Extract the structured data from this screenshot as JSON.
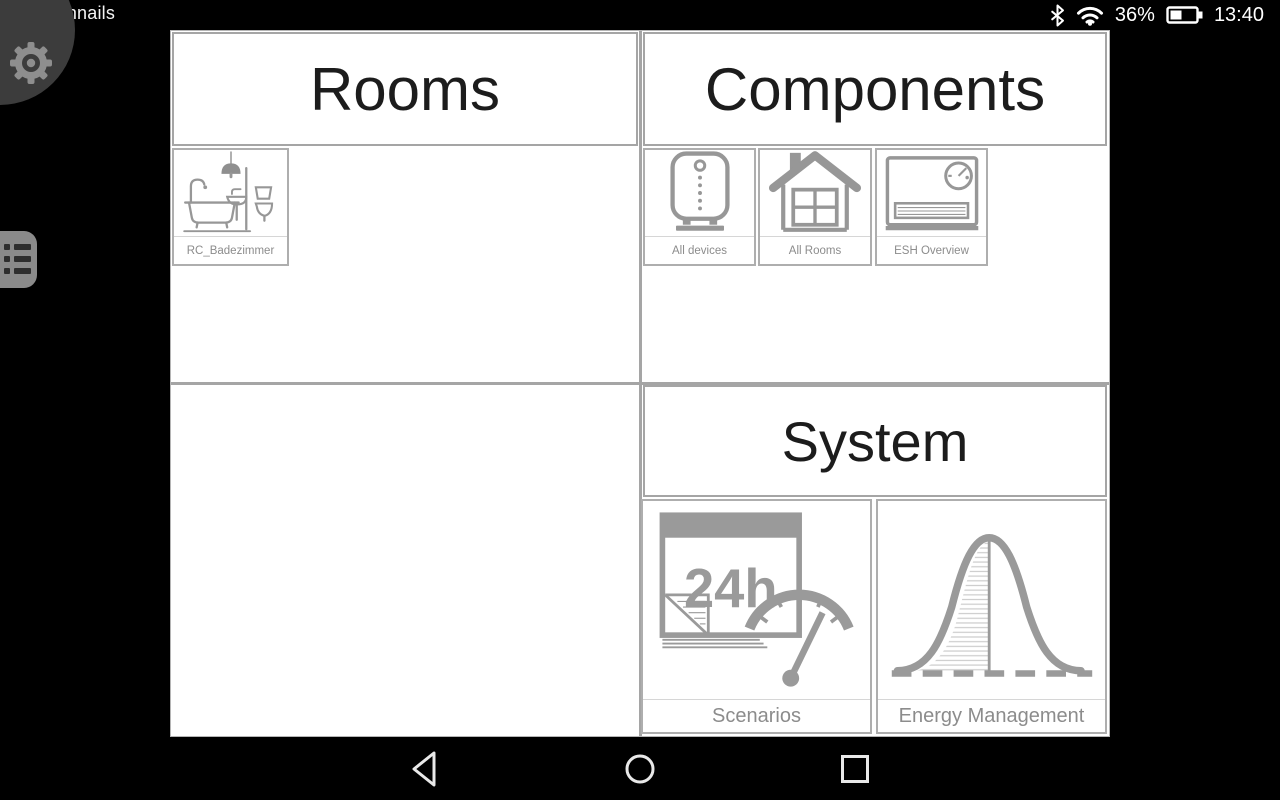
{
  "status_bar": {
    "device_name": "8inchnails",
    "battery_percent": "36%",
    "time": "13:40",
    "icons": [
      "bluetooth-icon",
      "wifi-icon",
      "battery-icon"
    ]
  },
  "sections": {
    "rooms": {
      "title": "Rooms",
      "tiles": [
        {
          "label": "RC_Badezimmer",
          "icon": "bathroom-icon"
        }
      ]
    },
    "components": {
      "title": "Components",
      "tiles": [
        {
          "label": "All devices",
          "icon": "smart-device-icon"
        },
        {
          "label": "All Rooms",
          "icon": "house-icon"
        },
        {
          "label": "ESH Overview",
          "icon": "heater-icon"
        }
      ]
    },
    "system": {
      "title": "System",
      "tiles": [
        {
          "label": "Scenarios",
          "icon": "calendar-gauge-icon",
          "icon_text": "24h"
        },
        {
          "label": "Energy Management",
          "icon": "bell-curve-icon"
        }
      ]
    }
  },
  "side_controls": {
    "settings": "gear-icon",
    "menu": "list-menu-icon"
  },
  "nav_bar": {
    "back": "back-icon",
    "home": "home-icon",
    "recents": "recents-icon"
  },
  "colors": {
    "grid_border": "#a5a5a5",
    "tile_border": "#aeaeae",
    "icon_stroke": "#979797",
    "label_text": "#8c8c8c",
    "header_text": "#1c1c1c",
    "status_text": "#ffffff",
    "blob_bg": "#3c3c3c",
    "menu_bg": "#8a8a8a"
  }
}
